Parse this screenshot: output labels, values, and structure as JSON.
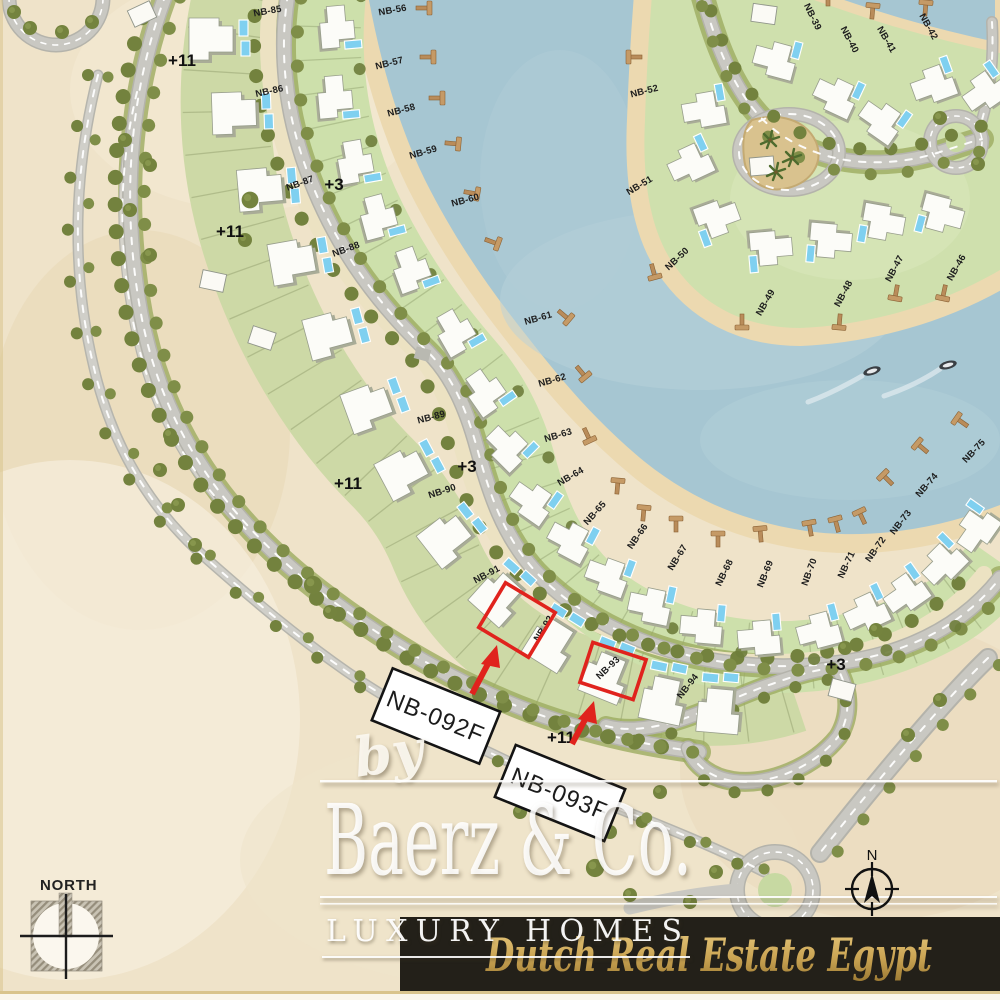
{
  "map": {
    "plot_labels": [
      {
        "text": "NB-85",
        "x": 268,
        "y": 14,
        "r": -10
      },
      {
        "text": "NB-86",
        "x": 270,
        "y": 94,
        "r": -12
      },
      {
        "text": "NB-87",
        "x": 301,
        "y": 186,
        "r": -20
      },
      {
        "text": "NB-88",
        "x": 347,
        "y": 252,
        "r": -20
      },
      {
        "text": "NB-89",
        "x": 432,
        "y": 420,
        "r": -15
      },
      {
        "text": "NB-90",
        "x": 443,
        "y": 494,
        "r": -18
      },
      {
        "text": "NB-91",
        "x": 488,
        "y": 577,
        "r": -28
      },
      {
        "text": "NB-92",
        "x": 546,
        "y": 630,
        "r": -58
      },
      {
        "text": "NB-93",
        "x": 610,
        "y": 670,
        "r": -43
      },
      {
        "text": "NB-94",
        "x": 690,
        "y": 688,
        "r": -52
      },
      {
        "text": "NB-56",
        "x": 393,
        "y": 13,
        "r": -10
      },
      {
        "text": "NB-57",
        "x": 390,
        "y": 66,
        "r": -14
      },
      {
        "text": "NB-58",
        "x": 402,
        "y": 113,
        "r": -15
      },
      {
        "text": "NB-59",
        "x": 424,
        "y": 155,
        "r": -16
      },
      {
        "text": "NB-60",
        "x": 466,
        "y": 203,
        "r": -15
      },
      {
        "text": "NB-61",
        "x": 539,
        "y": 321,
        "r": -16
      },
      {
        "text": "NB-62",
        "x": 553,
        "y": 383,
        "r": -16
      },
      {
        "text": "NB-63",
        "x": 559,
        "y": 438,
        "r": -17
      },
      {
        "text": "NB-64",
        "x": 572,
        "y": 479,
        "r": -30
      },
      {
        "text": "NB-65",
        "x": 597,
        "y": 515,
        "r": -48
      },
      {
        "text": "NB-66",
        "x": 640,
        "y": 538,
        "r": -55
      },
      {
        "text": "NB-67",
        "x": 680,
        "y": 559,
        "r": -58
      },
      {
        "text": "NB-68",
        "x": 727,
        "y": 574,
        "r": -64
      },
      {
        "text": "NB-69",
        "x": 768,
        "y": 575,
        "r": -68
      },
      {
        "text": "NB-70",
        "x": 812,
        "y": 573,
        "r": -70
      },
      {
        "text": "NB-71",
        "x": 849,
        "y": 566,
        "r": -65
      },
      {
        "text": "NB-72",
        "x": 878,
        "y": 551,
        "r": -55
      },
      {
        "text": "NB-73",
        "x": 903,
        "y": 524,
        "r": -52
      },
      {
        "text": "NB-74",
        "x": 929,
        "y": 487,
        "r": -49
      },
      {
        "text": "NB-75",
        "x": 976,
        "y": 453,
        "r": -47
      },
      {
        "text": "NB-52",
        "x": 645,
        "y": 94,
        "r": -14
      },
      {
        "text": "NB-51",
        "x": 641,
        "y": 188,
        "r": -31
      },
      {
        "text": "NB-50",
        "x": 679,
        "y": 261,
        "r": -43
      },
      {
        "text": "NB-49",
        "x": 768,
        "y": 304,
        "r": -60
      },
      {
        "text": "NB-48",
        "x": 846,
        "y": 295,
        "r": -62
      },
      {
        "text": "NB-47",
        "x": 897,
        "y": 270,
        "r": -62
      },
      {
        "text": "NB-46",
        "x": 959,
        "y": 269,
        "r": -60
      },
      {
        "text": "NB-39",
        "x": 810,
        "y": 18,
        "r": 64
      },
      {
        "text": "NB-40",
        "x": 847,
        "y": 41,
        "r": 62
      },
      {
        "text": "NB-41",
        "x": 884,
        "y": 41,
        "r": 60
      },
      {
        "text": "NB-42",
        "x": 926,
        "y": 28,
        "r": 61
      }
    ],
    "elevation_labels": [
      {
        "text": "+11",
        "x": 182,
        "y": 66
      },
      {
        "text": "+11",
        "x": 230,
        "y": 237
      },
      {
        "text": "+11",
        "x": 348,
        "y": 489
      },
      {
        "text": "+11",
        "x": 561,
        "y": 743
      },
      {
        "text": "+3",
        "x": 334,
        "y": 190
      },
      {
        "text": "+3",
        "x": 467,
        "y": 472
      },
      {
        "text": "+3",
        "x": 836,
        "y": 670
      }
    ],
    "callouts": [
      {
        "label": "NB-092F"
      },
      {
        "label": "NB-093F"
      }
    ],
    "highlighted_plots": [
      "NB-92",
      "NB-93"
    ]
  },
  "watermark": {
    "by": "by",
    "brand": "Baerz & Co.",
    "tagline": "LUXURY HOMES",
    "banner": "Dutch Real Estate Egypt"
  },
  "compass": {
    "north_label": "NORTH",
    "rose_letter": "N"
  },
  "colors": {
    "sand": "#efe3c9",
    "water": "#a6c6d2",
    "band_green": "#cdd9a6",
    "road": "#c9c8c2",
    "promenade": "#ece2c2",
    "highlight_red": "#e0231d",
    "banner_bg": "#232019",
    "banner_gold": "#c9a452"
  }
}
